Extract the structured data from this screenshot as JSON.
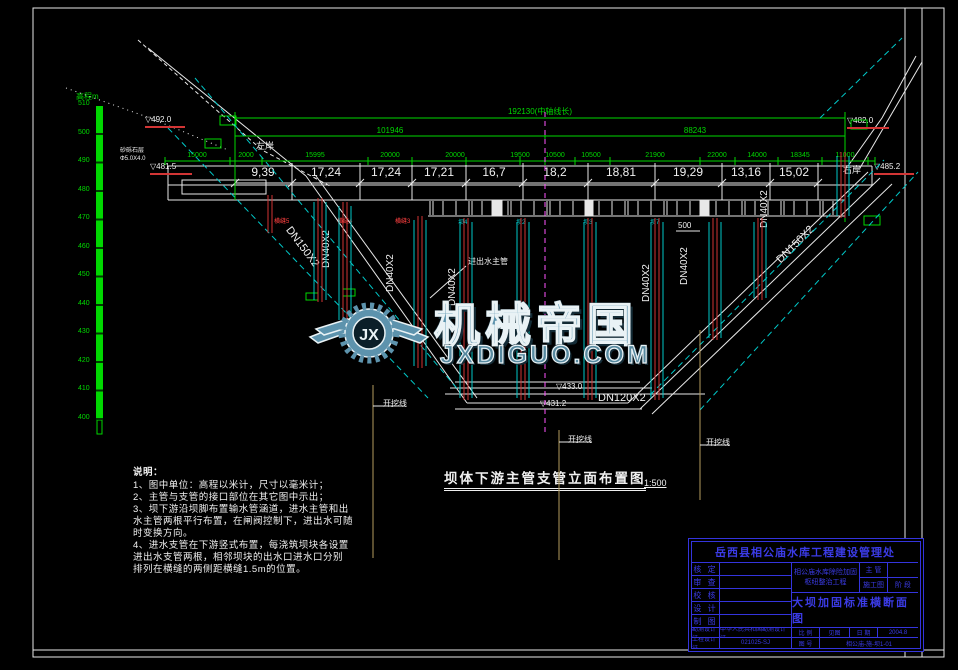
{
  "drawing": {
    "watermark": {
      "brand": "机械帝国",
      "site": "JXDIGUO.COM",
      "logo_monogram": "JX"
    },
    "caption": {
      "title": "坝体下游主管支管立面布置图",
      "scale": "1:500"
    },
    "elev_scale": {
      "title": "高程m",
      "ticks": [
        "510",
        "500",
        "490",
        "480",
        "470",
        "460",
        "450",
        "440",
        "430",
        "420",
        "410",
        "400"
      ]
    },
    "top_dims": {
      "overall": "192130(中轴线长)",
      "left_total": "101946",
      "right_total": "88243",
      "segments": [
        "15000",
        "2000",
        "15995",
        "20000",
        "20000",
        "19500",
        "10500",
        "10500",
        "21900",
        "22000",
        "14000",
        "18345",
        "11000"
      ],
      "main": [
        "9,39",
        "17,24",
        "17,24",
        "17,21",
        "16,7",
        "18,2",
        "18,81",
        "19,29",
        "13,16",
        "15,02"
      ]
    },
    "banks": {
      "left": "左岸",
      "right": "右岸"
    },
    "pipes": {
      "dn150_left": "DN150X2",
      "dn150_right": "DN150X2",
      "dn120": "DN120X2",
      "dn40": [
        "DN40X2",
        "DN40X2",
        "DN40X2",
        "DN40X2",
        "DN40X2",
        "DN40X2"
      ]
    },
    "elevations": {
      "e1": "▽492.0",
      "e2": "▽481.5",
      "e3": "▽482.0",
      "e4": "▽485.2",
      "e5": "▽433.0",
      "e6": "▽431.2"
    },
    "misc": {
      "excavation": "开挖线",
      "main_pipe": "进出水主管",
      "joint_labels": [
        "横缝5",
        "横缝4",
        "横缝3"
      ],
      "block_labels": [
        "坝4",
        "坝2",
        "坝3",
        "坝7"
      ],
      "dim500": "500",
      "stratum": "砂砾石层",
      "geo": "Φ5.0X4.0"
    },
    "notes": {
      "title": "说明：",
      "lines": [
        "1、图中单位：高程以米计，尺寸以毫米计；",
        "2、主管与支管的接口部位在其它图中示出；",
        "3、坝下游沿坝脚布置输水管涵道，进水主管和出",
        "水主管两根平行布置，在闸阀控制下，进出水可随",
        "时变换方向。",
        "4、进水支管在下游竖式布置，每浇筑坝块各设置",
        "进出水支管两根，相邻坝块的出水口进水口分别",
        "排列在横缝的两侧距横缝1.5m的位置。"
      ]
    },
    "titleblock": {
      "org": "岳西县相公庙水库工程建设管理处",
      "rows": [
        "核 定",
        "审 查",
        "校 核",
        "设 计",
        "制 图"
      ],
      "project": "相公庙水库除险加固枢纽整治工程",
      "right_rows": [
        {
          "label": "主 管",
          "value": ""
        },
        {
          "label": "施工图",
          "value": "阶 段"
        }
      ],
      "drawing_title": "大坝加固标准横断面图",
      "cert1_label": "勘测设计证",
      "cert1_value": "中华人民共和国勘测设计证",
      "cert2_label": "工程设计证",
      "cert2_value": "021025-SJ",
      "scale_label": "比 例",
      "scale_value": "见图",
      "date_label": "日 期",
      "date_value": "2004.8",
      "no_label": "图 号",
      "no_value": "相公庙-施-坝1-01"
    }
  }
}
